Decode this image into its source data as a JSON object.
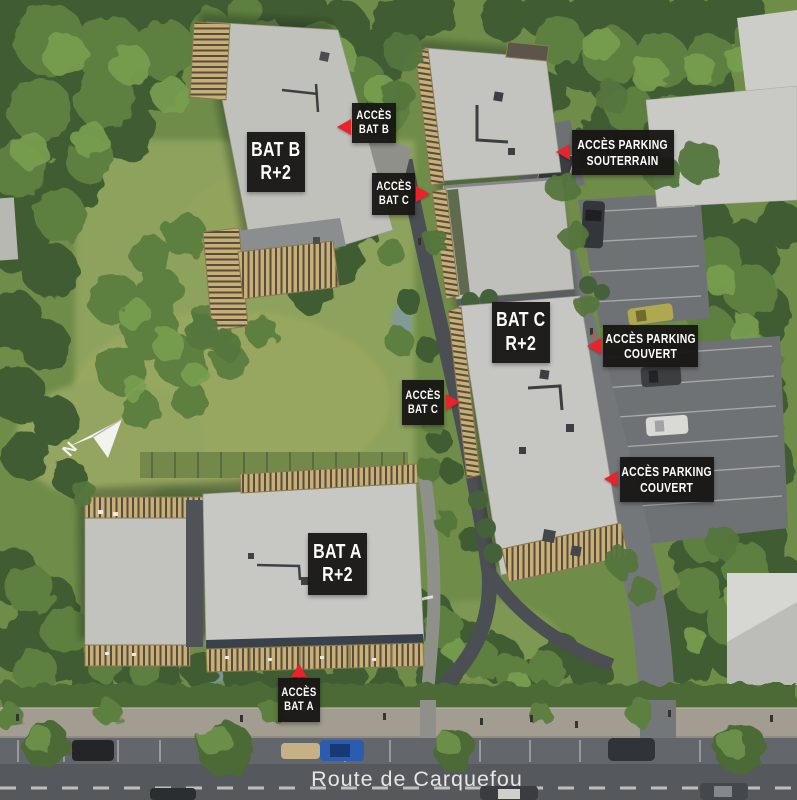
{
  "labels": {
    "building": {
      "bat_a": {
        "line1": "BAT A",
        "line2": "R+2"
      },
      "bat_b": {
        "line1": "BAT B",
        "line2": "R+2"
      },
      "bat_c": {
        "line1": "BAT C",
        "line2": "R+2"
      }
    },
    "access": {
      "bat_b": {
        "line1": "ACCÈS",
        "line2": "BAT B"
      },
      "bat_c_top": {
        "line1": "ACCÈS",
        "line2": "BAT C"
      },
      "bat_c_mid": {
        "line1": "ACCÈS",
        "line2": "BAT C"
      },
      "bat_a": {
        "line1": "ACCÈS",
        "line2": "BAT A"
      },
      "parking_souterrain": {
        "line1": "ACCÈS PARKING",
        "line2": "SOUTERRAIN"
      },
      "parking_couvert_upper": {
        "line1": "ACCÈS PARKING",
        "line2": "COUVERT"
      },
      "parking_couvert_lower": {
        "line1": "ACCÈS PARKING",
        "line2": "COUVERT"
      }
    }
  },
  "road": {
    "name": "Route de Carquefou"
  },
  "compass": {
    "letter": "N"
  },
  "colors": {
    "label_background": "#191715",
    "label_text": "#ffffff",
    "arrow_red": "#e8232b",
    "roof_light_gray": "#c5c5c1",
    "terrace_wood": "#c9ae77",
    "vegetation_green": "#5d7f3f",
    "asphalt": "#55585c",
    "water_blue": "#7d98aa"
  }
}
